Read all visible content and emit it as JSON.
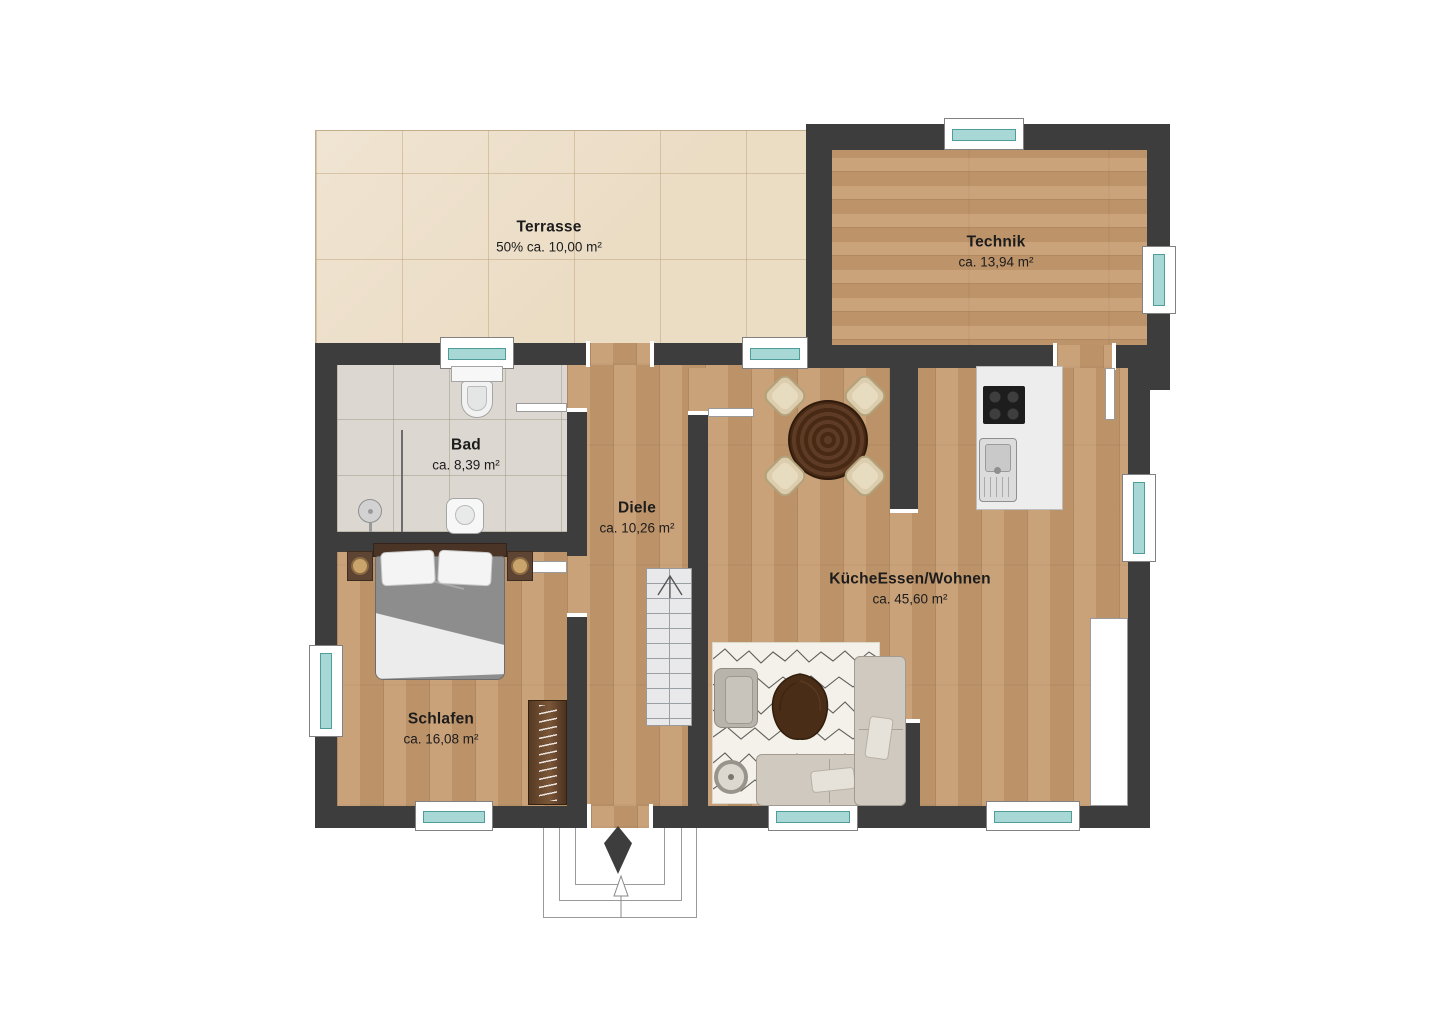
{
  "plan_type": "floor-plan",
  "rooms": {
    "terrasse": {
      "name": "Terrasse",
      "area": "50% ca. 10,00 m²"
    },
    "technik": {
      "name": "Technik",
      "area": "ca. 13,94 m²"
    },
    "bad": {
      "name": "Bad",
      "area": "ca. 8,39 m²"
    },
    "diele": {
      "name": "Diele",
      "area": "ca. 10,26 m²"
    },
    "wohnen": {
      "name": "KücheEssen/Wohnen",
      "area": "ca. 45,60 m²"
    },
    "schlafen": {
      "name": "Schlafen",
      "area": "ca. 16,08 m²"
    }
  },
  "colors": {
    "wall": "#3d3d3d",
    "wood_floor": "#c69a6e",
    "terrace_tile": "#ebdcc4",
    "bath_tile": "#dcd8d1",
    "window_glass": "#a8d8d5",
    "dark_furniture_wood": "#4a2d17"
  },
  "furniture_icons": [
    "stairs",
    "entrance-arrow",
    "double-bed",
    "nightstand",
    "wardrobe",
    "dining-table",
    "dining-chair",
    "kitchen-island",
    "cooktop",
    "kitchen-sink",
    "sofa",
    "armchair",
    "coffee-table",
    "rug",
    "floor-lamp",
    "sideboard",
    "toilet",
    "washbasin",
    "shower-head",
    "shower-glass"
  ]
}
